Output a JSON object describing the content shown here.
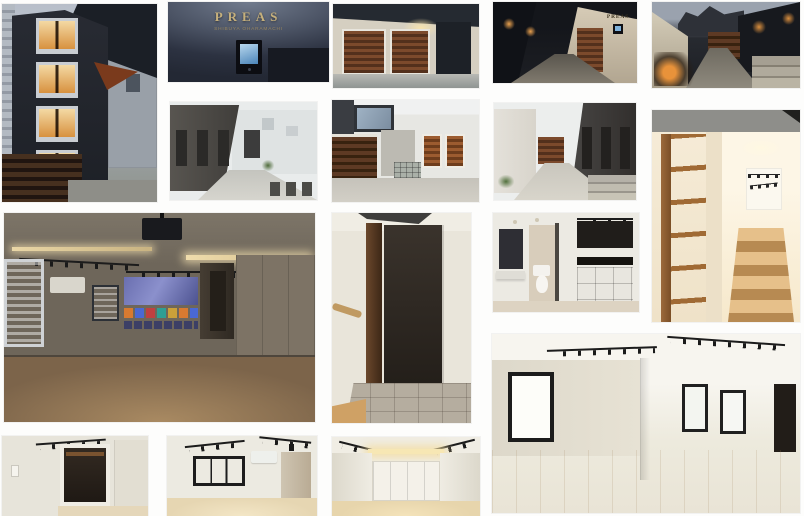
{
  "page": {
    "kind": "scanned photo collage page",
    "background": "#fdfdfc",
    "photo_count": 16
  },
  "brand": {
    "name": "PREAS",
    "subtitle": "SHIBUYA OHARAMACHI",
    "sign_letter_color": "#c6b07c"
  },
  "palette": {
    "night_dark": "#1d2127",
    "wood_brown": "#8a5634",
    "warm_light": "#e8c27a",
    "concrete_grey": "#c6c4bc",
    "interior_white": "#efece3",
    "track_light_black": "#1c1c1c",
    "screen_blue": "#6a6fb0"
  },
  "photos": {
    "building_night": {
      "description": "Narrow modern building exterior at dusk with dark facade, stacked warm-lit windows and wooden slat fence"
    },
    "preas_sign": {
      "description": "Brass PREAS lettering above a glowing video intercom on a dark wall"
    },
    "entrance_twilight": {
      "description": "Entrance court at twilight with two wooden louver doors and a dark panel"
    },
    "alley_night": {
      "description": "Night approach alley with warm sconce lights and PREAS wall sign"
    },
    "courtyard_night": {
      "description": "Night courtyard with uplit planting, wooden gate and concrete steps"
    },
    "alley_day": {
      "description": "Daytime alley along a dark textured wall with recessed doors"
    },
    "courtyard_day": {
      "description": "Daytime court with dark wooden fence, louvered shutters and glass-block box"
    },
    "alley_day_2": {
      "description": "Daytime path between white wall and dark textured wall leading to a wooden gate"
    },
    "staircase_shelves": {
      "description": "Warm-lit wooden staircase with built-in open shelving"
    },
    "projector_room": {
      "description": "Dim studio room with ceiling projector, projected streaming screen, track lights, blinds and wood floor"
    },
    "entry_hall": {
      "description": "Entry hall with dark accent wall, wood post and grey tile floor"
    },
    "bath_kitchen": {
      "description": "Washroom and toilet beside a black kitchenette with open cubby shelving"
    },
    "living_room_wide": {
      "description": "Bright white room pair with black framed windows, track lighting and pale wood floor"
    },
    "room_closet": {
      "description": "Bright room corner with dark open closet and hanger rod"
    },
    "room_window": {
      "description": "Bright room with black framed window, air conditioner and side alcove"
    },
    "room_double_doors": {
      "description": "Bright room with white double closet doors under a warm cove light"
    }
  }
}
